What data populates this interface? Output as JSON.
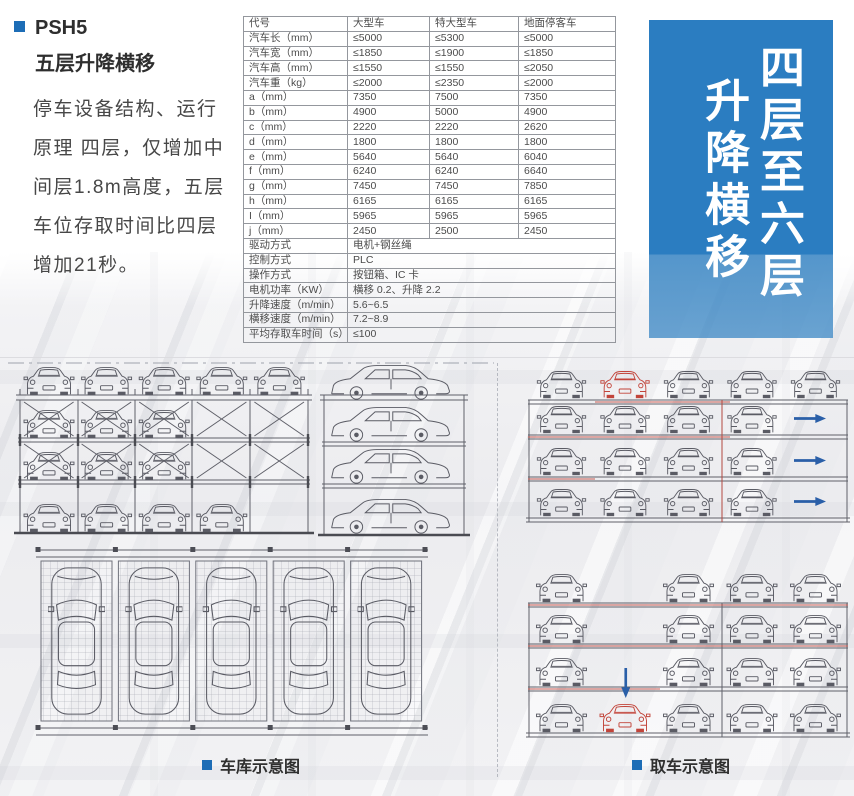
{
  "page": {
    "product_code": "PSH5",
    "product_name": "五层升降横移",
    "description": "停车设备结构、运行原理 四层，仅增加中间层1.8m高度，五层车位存取时间比四层增加21秒。",
    "accent_color": "#1d6db6"
  },
  "banner": {
    "line1": "四层至六层",
    "line2": "升降横移",
    "bg_color": "#2b7dc1",
    "text_color": "#ffffff"
  },
  "captions": {
    "left": "车库示意图",
    "right": "取车示意图"
  },
  "spec_table": {
    "headers": [
      "代号",
      "大型车",
      "特大型车",
      "地面停客车"
    ],
    "rows": [
      [
        "汽车长（mm）",
        "≤5000",
        "≤5300",
        "≤5000"
      ],
      [
        "汽车宽（mm）",
        "≤1850",
        "≤1900",
        "≤1850"
      ],
      [
        "汽车高（mm）",
        "≤1550",
        "≤1550",
        "≤2050"
      ],
      [
        "汽车重（kg）",
        "≤2000",
        "≤2350",
        "≤2000"
      ],
      [
        "a（mm）",
        "7350",
        "7500",
        "7350"
      ],
      [
        "b（mm）",
        "4900",
        "5000",
        "4900"
      ],
      [
        "c（mm）",
        "2220",
        "2220",
        "2620"
      ],
      [
        "d（mm）",
        "1800",
        "1800",
        "1800"
      ],
      [
        "e（mm）",
        "5640",
        "5640",
        "6040"
      ],
      [
        "f（mm）",
        "6240",
        "6240",
        "6640"
      ],
      [
        "g（mm）",
        "7450",
        "7450",
        "7850"
      ],
      [
        "h（mm）",
        "6165",
        "6165",
        "6165"
      ],
      [
        "I（mm）",
        "5965",
        "5965",
        "5965"
      ],
      [
        "j（mm）",
        "2450",
        "2500",
        "2450"
      ]
    ],
    "merged_rows": [
      [
        "驱动方式",
        "电机+钢丝绳"
      ],
      [
        "控制方式",
        "PLC"
      ],
      [
        "操作方式",
        "按钮箱、IC 卡"
      ],
      [
        "电机功率（KW）",
        "横移 0.2、升降 2.2"
      ],
      [
        "升降速度（m/min）",
        "5.6~6.5"
      ],
      [
        "横移速度（m/min）",
        "7.2~8.9"
      ],
      [
        "平均存取车时间（s）",
        "≤100"
      ]
    ]
  },
  "diagrams": {
    "garage_front_grid": [
      [
        "car",
        "car",
        "car",
        "car",
        "car"
      ],
      [
        "car_brace",
        "car_brace",
        "car_brace",
        "brace",
        "brace"
      ],
      [
        "car_brace",
        "car_brace",
        "car_brace",
        "brace",
        "brace"
      ],
      [
        "car",
        "car",
        "car",
        "car",
        "empty"
      ]
    ],
    "garage_side_cars": 4,
    "garage_plan_bays": 5,
    "retrieval_top_grid": [
      [
        "car",
        "car_red",
        "car",
        "car",
        "car"
      ],
      [
        "car",
        "car",
        "car",
        "car",
        "arrow_right"
      ],
      [
        "car",
        "car",
        "car",
        "car",
        "arrow_right"
      ],
      [
        "car",
        "car",
        "car",
        "car",
        "arrow_right"
      ]
    ],
    "retrieval_bottom_grid": [
      [
        "car",
        "empty",
        "car",
        "car",
        "car"
      ],
      [
        "car",
        "empty",
        "car",
        "car",
        "car"
      ],
      [
        "car",
        "arrow_down",
        "car",
        "car",
        "car"
      ],
      [
        "car",
        "car_red",
        "car",
        "car",
        "car"
      ]
    ]
  }
}
